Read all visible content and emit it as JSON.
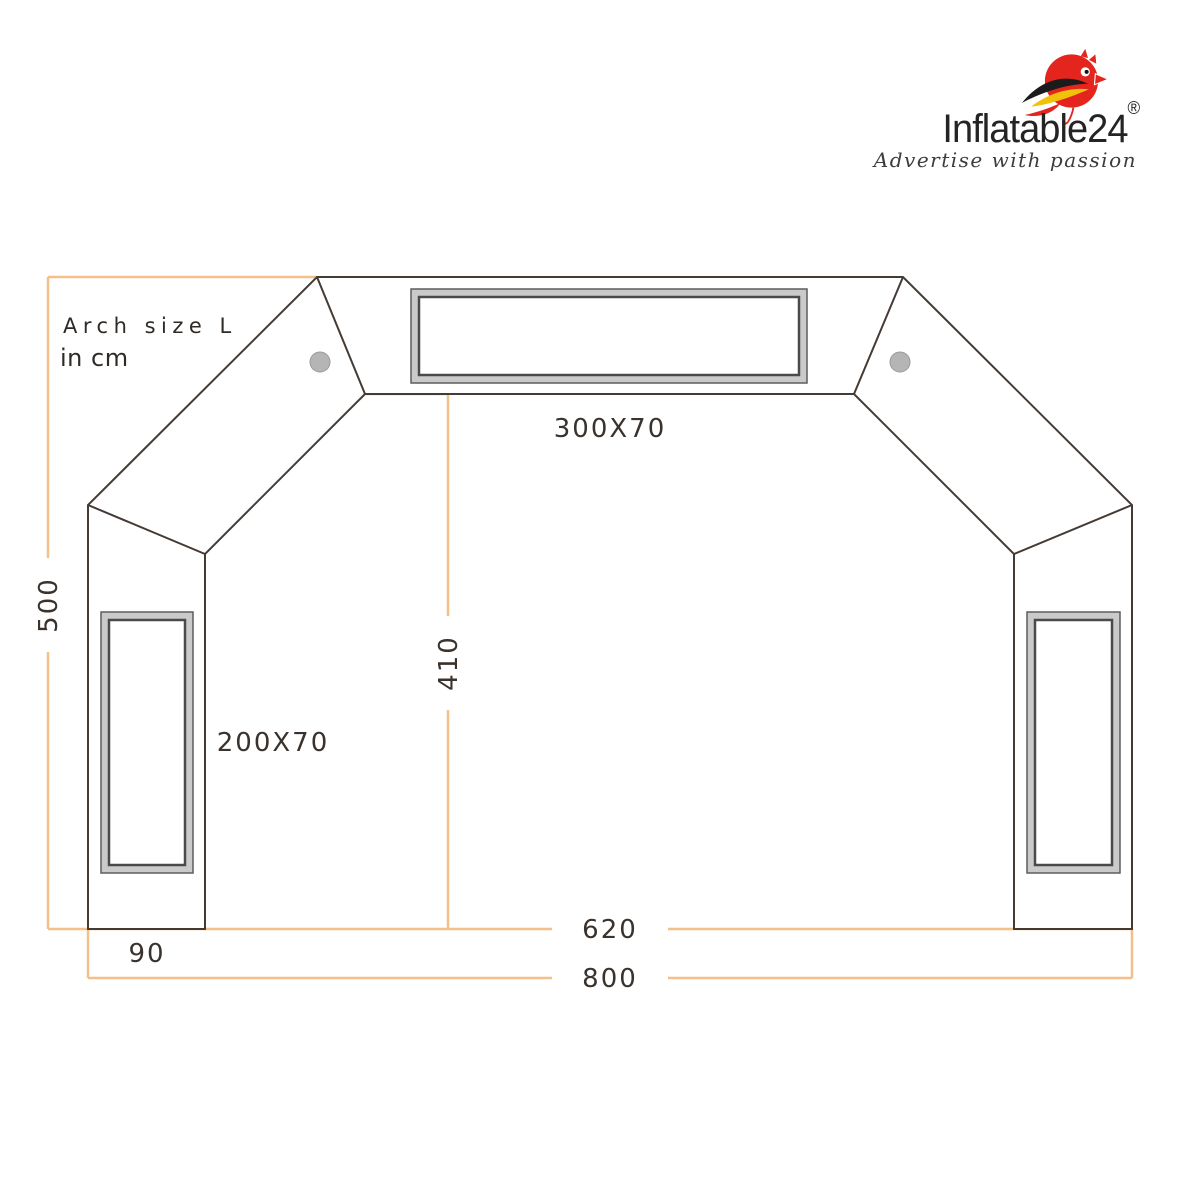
{
  "logo": {
    "brand": "Inflatable24",
    "registered_mark": "®",
    "tagline": "Advertise with passion",
    "colors": {
      "bird_body": "#e4251e",
      "bird_wing": "#1b1b1b",
      "bird_accent": "#f2c10a",
      "text": "#242424"
    }
  },
  "annotation": {
    "title": "Arch size L",
    "unit": "in cm"
  },
  "dimensions": {
    "top_banner": "300X70",
    "side_banner": "200X70",
    "total_height": "500",
    "inner_height": "410",
    "inner_width": "620",
    "leg_width": "90",
    "total_width": "800"
  },
  "colors": {
    "outline": "#453b35",
    "dimension_line": "#f4c08a",
    "banner_frame": "#cacaca",
    "label_text": "#3a322c"
  }
}
